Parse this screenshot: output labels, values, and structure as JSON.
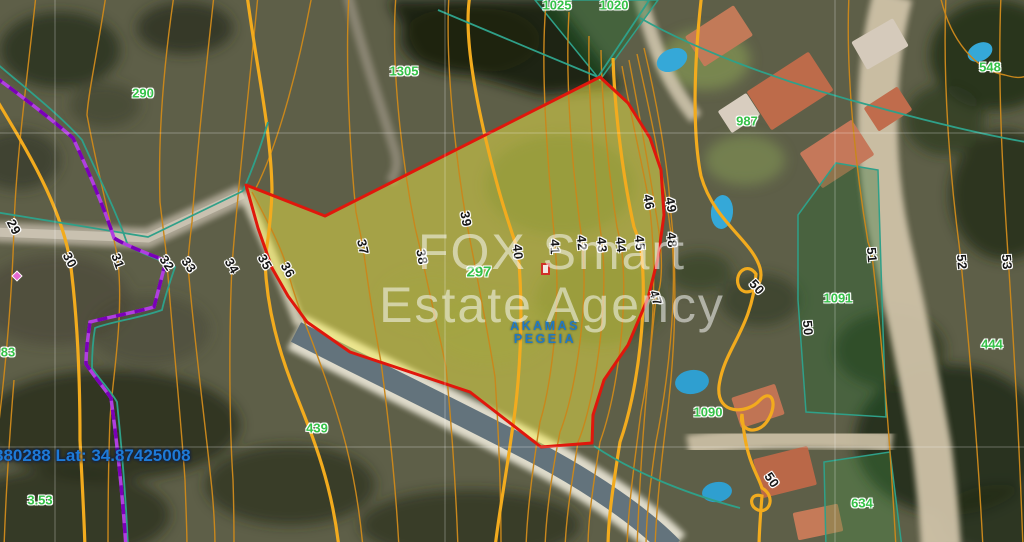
{
  "map": {
    "watermark": {
      "line1": "FOX Smart",
      "line2": "Estate Agency"
    },
    "coordinates_text": "380288 Lat: 34.87425008",
    "area_name": {
      "line1": "AKAMAS",
      "line2": "PEGEIA"
    },
    "selected_parcel": {
      "id": "297"
    },
    "colors": {
      "selected_boundary": "#e0170c",
      "selected_fill": "rgba(253,244,70,0.45)",
      "contour_line": "#c9871c",
      "contour_index_line": "#f2ab1e",
      "parcel_boundary_line": "#2fa089",
      "zoning_line_purple": "#9b1fd4",
      "parcel_id_text": "#35c148",
      "elevation_text": "#161616",
      "coordinate_text": "#1e7ad6",
      "area_name_text": "#2179c2",
      "watermark_text": "rgba(255,255,255,0.52)"
    },
    "elevation_labels": [
      {
        "t": "29",
        "x": 14,
        "y": 227,
        "r": 62
      },
      {
        "t": "30",
        "x": 70,
        "y": 260,
        "r": 62
      },
      {
        "t": "31",
        "x": 118,
        "y": 261,
        "r": 70
      },
      {
        "t": "32",
        "x": 167,
        "y": 263,
        "r": 55
      },
      {
        "t": "33",
        "x": 189,
        "y": 265,
        "r": 55
      },
      {
        "t": "34",
        "x": 232,
        "y": 266,
        "r": 60
      },
      {
        "t": "35",
        "x": 265,
        "y": 262,
        "r": 60
      },
      {
        "t": "36",
        "x": 288,
        "y": 270,
        "r": 60
      },
      {
        "t": "37",
        "x": 363,
        "y": 247,
        "r": 78
      },
      {
        "t": "38",
        "x": 422,
        "y": 257,
        "r": 80
      },
      {
        "t": "39",
        "x": 466,
        "y": 219,
        "r": 80
      },
      {
        "t": "40",
        "x": 518,
        "y": 252,
        "r": 85
      },
      {
        "t": "41",
        "x": 555,
        "y": 247,
        "r": 88
      },
      {
        "t": "42",
        "x": 582,
        "y": 243,
        "r": 85
      },
      {
        "t": "43",
        "x": 602,
        "y": 245,
        "r": 85
      },
      {
        "t": "44",
        "x": 621,
        "y": 245,
        "r": 85
      },
      {
        "t": "45",
        "x": 640,
        "y": 243,
        "r": 85
      },
      {
        "t": "46",
        "x": 649,
        "y": 202,
        "r": 80
      },
      {
        "t": "49",
        "x": 671,
        "y": 205,
        "r": 80
      },
      {
        "t": "48",
        "x": 672,
        "y": 240,
        "r": 85
      },
      {
        "t": "47",
        "x": 656,
        "y": 298,
        "r": 70
      },
      {
        "t": "50",
        "x": 757,
        "y": 287,
        "r": 48
      },
      {
        "t": "50",
        "x": 808,
        "y": 328,
        "r": 85
      },
      {
        "t": "50",
        "x": 772,
        "y": 480,
        "r": 55
      },
      {
        "t": "51",
        "x": 872,
        "y": 255,
        "r": 85
      },
      {
        "t": "52",
        "x": 962,
        "y": 262,
        "r": 85
      },
      {
        "t": "53",
        "x": 1007,
        "y": 262,
        "r": 85
      }
    ],
    "parcel_labels": [
      {
        "t": "290",
        "x": 143,
        "y": 93
      },
      {
        "t": "1305",
        "x": 404,
        "y": 71
      },
      {
        "t": "1025",
        "x": 557,
        "y": 5
      },
      {
        "t": "1020",
        "x": 614,
        "y": 5
      },
      {
        "t": "987",
        "x": 747,
        "y": 121
      },
      {
        "t": "548",
        "x": 990,
        "y": 67
      },
      {
        "t": "297",
        "x": 479,
        "y": 272,
        "fs": 15
      },
      {
        "t": "83",
        "x": 8,
        "y": 352
      },
      {
        "t": "3.53",
        "x": 40,
        "y": 500
      },
      {
        "t": "439",
        "x": 317,
        "y": 428
      },
      {
        "t": "1090",
        "x": 708,
        "y": 412
      },
      {
        "t": "1091",
        "x": 838,
        "y": 298
      },
      {
        "t": "634",
        "x": 862,
        "y": 503
      },
      {
        "t": "444",
        "x": 992,
        "y": 344
      }
    ]
  }
}
